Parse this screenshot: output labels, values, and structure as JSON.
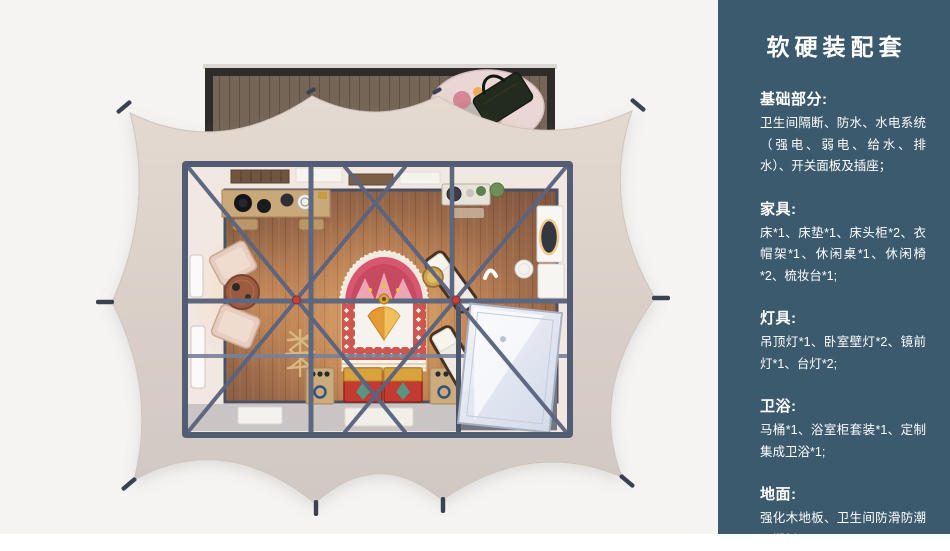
{
  "window": {
    "width": 950,
    "height": 534
  },
  "theme": {
    "page_bg": "#f5f4f2",
    "sidebar_bg": "#3c5a6d",
    "sidebar_text": "#ffffff",
    "tent_canvas": "#dcd2c9",
    "steel_frame": "#5a6480",
    "joint_red": "#c2413f",
    "wood_floor": "#a06b48",
    "deck_wood": "#756556",
    "chest_red": "#c23a31",
    "accent_gold": "#d9a33c"
  },
  "sidebar": {
    "title": "软硬装配套",
    "sections": [
      {
        "heading": "基础部分:",
        "body": "卫生间隔断、防水、水电系统（强电、弱电、给水、排水）、开关面板及插座；"
      },
      {
        "heading": "家具:",
        "body": "床*1、床垫*1、床头柜*2、衣帽架*1、休闲桌*1、休闲椅*2、梳妆台*1;"
      },
      {
        "heading": "灯具:",
        "body": "吊顶灯*1、卧室壁灯*2、镜前灯*1、台灯*2;"
      },
      {
        "heading": "卫浴:",
        "body": "马桶*1、浴室柜套装*1、定制集成卫浴*1;"
      },
      {
        "heading": "地面:",
        "body": "强化木地板、卫生间防滑防潮石塑板;"
      }
    ]
  },
  "floorplan": {
    "elements": [
      "wood-deck",
      "outdoor-rug",
      "tote-bag",
      "tent-canvas",
      "tie-down",
      "steel-frame",
      "truss-brace",
      "console-desk",
      "stool",
      "armchair",
      "tea-table",
      "bed",
      "headboard-rug",
      "pillows",
      "storage-chest",
      "nightstand",
      "coat-rack",
      "lounge-chair",
      "side-table",
      "washstand",
      "ceiling-lamp",
      "wall-lamp",
      "dressing-table",
      "mirror",
      "vanity-stool",
      "shower-enclosure",
      "bathroom-floor",
      "window",
      "ceiling-vent",
      "door-mat"
    ]
  }
}
